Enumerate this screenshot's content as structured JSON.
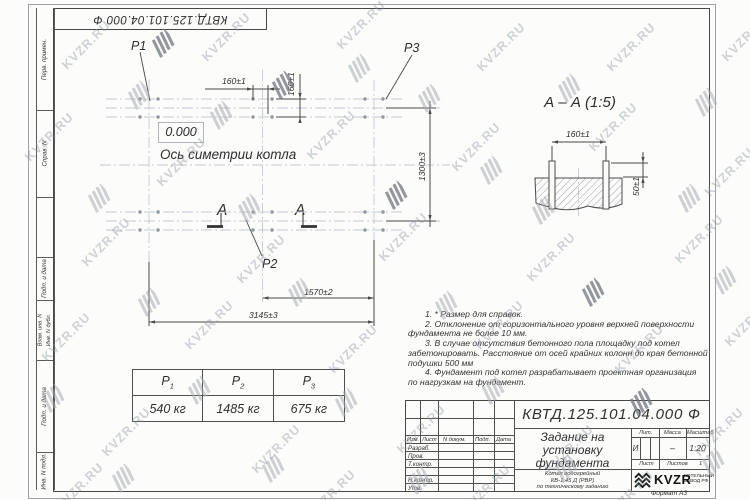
{
  "watermark": {
    "text": "KVZR.RU"
  },
  "sheet": {
    "doc_number": "КВТД.125.101.04.000 Ф",
    "format_note": "Формат А3"
  },
  "margin": {
    "labels": {
      "perv": "Перв. примен.",
      "sprav": "Справ. N",
      "podp1": "Подп. и дата",
      "vzam": "Взам. инв. N",
      "dubl": "Инв. N дубл.",
      "podp2": "Подп. и дата",
      "podl": "Инв. N подл."
    }
  },
  "plan": {
    "point_labels": {
      "p1": "P1",
      "p2": "P2",
      "p3": "P3"
    },
    "zero_mark": "0.000",
    "axis_label": "Ось симетрии котла",
    "section_letter": "А",
    "dims": {
      "bolt_spacing_x": "160±1",
      "bolt_spacing_y": "160±1",
      "row_spacing": "1300±3",
      "half_length": "1570±2",
      "full_length": "3145±3"
    }
  },
  "section_view": {
    "title": "А – А (1:5)",
    "dims": {
      "bolt_spacing": "160±1",
      "protrusion": "50±1"
    }
  },
  "notes": {
    "lines": [
      {
        "text": "1.  * Размер для справок."
      },
      {
        "text": "2.  Отклонение от горизонтального уровня верхней поверхности"
      },
      {
        "text": "фундамента не более 10 мм."
      },
      {
        "text": "3.  В случае отсутствия бетонного пола площадку под котел"
      },
      {
        "text": "забетонировать. Расстояние от осей крайних колонн до края бетонной"
      },
      {
        "text": "подушки 500 мм"
      },
      {
        "text": "4.  Фундамент под котел разрабатывает проектная организация"
      },
      {
        "text": "по нагрузкам на фундамент."
      }
    ]
  },
  "load_table": {
    "headers": [
      {
        "name": "P",
        "sub": "1"
      },
      {
        "name": "P",
        "sub": "2"
      },
      {
        "name": "P",
        "sub": "3"
      }
    ],
    "values": [
      "540 кг",
      "1485 кг",
      "675 кг"
    ]
  },
  "title_block": {
    "designation": "КВТД.125.101.04.000 Ф",
    "title_lines": [
      "Задание на",
      "установку",
      "фундамента"
    ],
    "product_lines": [
      "Котел водогрейный",
      "КВ-1,45 Д (РВР)",
      "по техническому заданию"
    ],
    "change_cols": {
      "izm": "Изм.",
      "list": "Лист",
      "ndoc": "N докум.",
      "podp": "Подп.",
      "data": "Дата"
    },
    "sign_rows": [
      "Разраб.",
      "Пров.",
      "Т.контр.",
      "",
      "Н.контр.",
      "Утв."
    ],
    "lit_label": "Лит.",
    "lit_value": "И",
    "mass_label": "Масса",
    "mass_value": "–",
    "scale_label": "Масштаб",
    "scale_value": "1:20",
    "sheet_label": "Лист",
    "sheets_label": "Листов",
    "sheets_value": "1",
    "logo_text": "KVZR",
    "logo_caption": [
      "КОТЕЛЬНЫЙ",
      "ЗАВОД РФ"
    ]
  }
}
